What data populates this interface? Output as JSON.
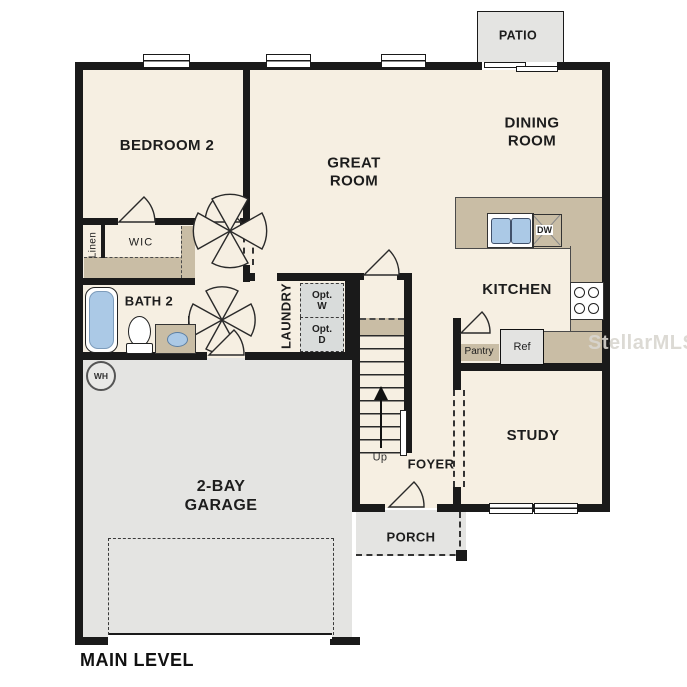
{
  "plan": {
    "level_label": "MAIN LEVEL",
    "watermark": "StellarMLS",
    "rooms": {
      "bedroom2": "BEDROOM 2",
      "great_room": "GREAT\nROOM",
      "dining_room": "DINING\nROOM",
      "kitchen": "KITCHEN",
      "study": "STUDY",
      "foyer": "FOYER",
      "laundry": "LAUNDRY",
      "bath2": "BATH 2",
      "wic": "WIC",
      "linen": "Linen",
      "garage": "2-BAY\nGARAGE",
      "porch": "PORCH",
      "patio": "PATIO",
      "pantry": "Pantry"
    },
    "fixtures": {
      "refrigerator": "Ref",
      "dishwasher": "DW",
      "water_heater": "WH",
      "optional_washer": "Opt.\nW",
      "optional_dryer": "Opt.\nD",
      "stairs_direction": "Up"
    },
    "colors": {
      "floor": "#f6efe2",
      "garage_porch_patio": "#e4e4e2",
      "counter_tile": "#c9bda5",
      "wall": "#1a1a1a",
      "fixture_blue": "#abc9e6"
    }
  }
}
